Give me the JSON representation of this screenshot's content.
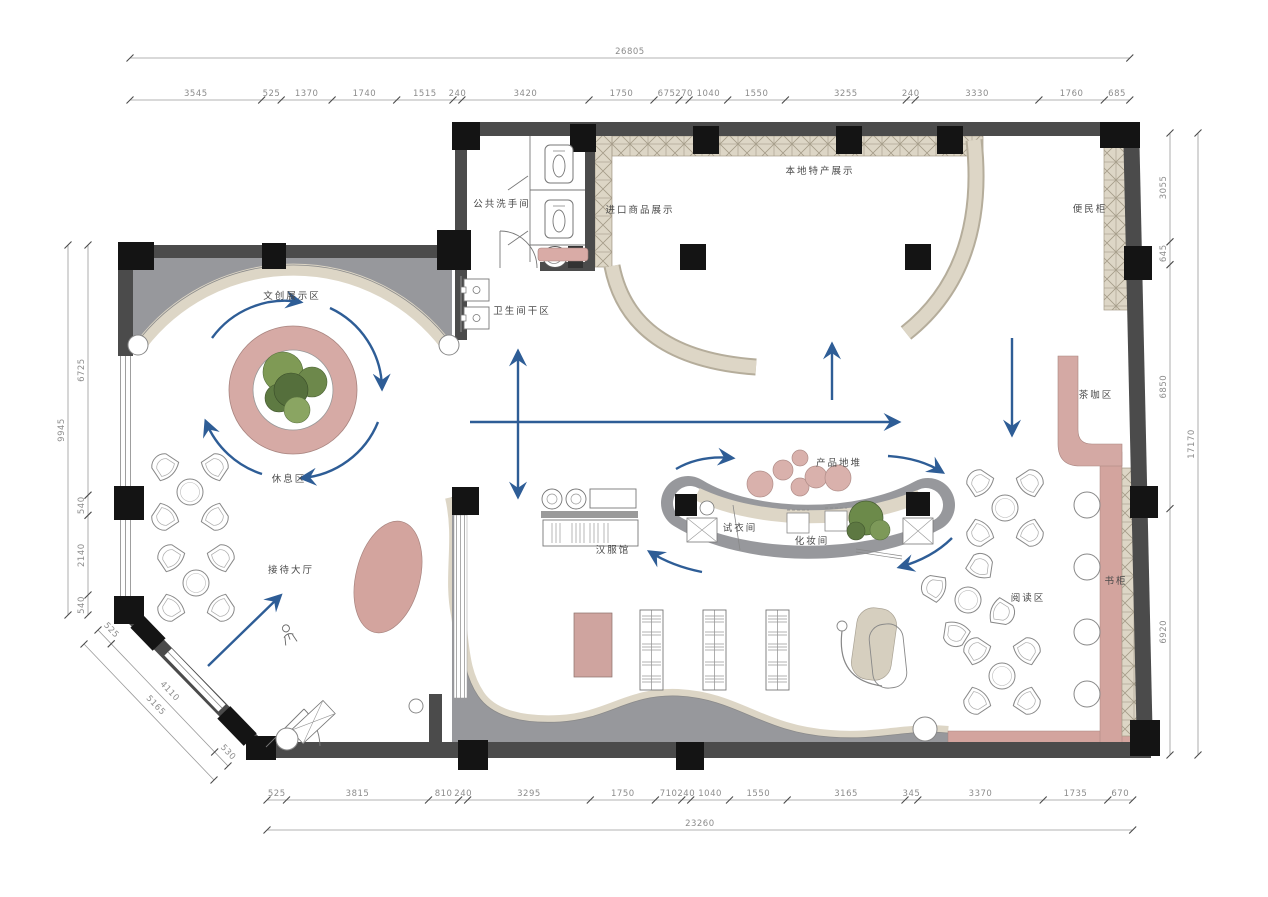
{
  "dims": {
    "top": {
      "overall": "26805",
      "values": [
        "3545",
        "525",
        "1370",
        "1740",
        "1515",
        "240",
        "3420",
        "1750",
        "675",
        "270",
        "1040",
        "1550",
        "3255",
        "240",
        "3330",
        "1760",
        "685"
      ]
    },
    "bottom": {
      "overall": "23260",
      "values": [
        "525",
        "3815",
        "810",
        "240",
        "3295",
        "1750",
        "710",
        "240",
        "1040",
        "1550",
        "3165",
        "345",
        "3370",
        "1735",
        "670"
      ]
    },
    "left": {
      "overall": "9945",
      "values": [
        "6725",
        "540",
        "2140",
        "540"
      ]
    },
    "right": {
      "overall": "17170",
      "values": [
        "3055",
        "645",
        "6850",
        "6920"
      ]
    },
    "diagonal": {
      "overall": "5165",
      "values": [
        "525",
        "4110",
        "530"
      ]
    }
  },
  "rooms": {
    "public_washroom": "公共洗手间",
    "toilet_dry_area": "卫生间干区",
    "imported_goods_display": "进口商品展示",
    "local_specialty_display": "本地特产展示",
    "convenience_cabinet": "便民柜",
    "cultural_creative_display": "文创展示区",
    "rest_area": "休息区",
    "reception_hall": "接待大厅",
    "tea_coffee_area": "茶咖区",
    "product_floor_stack": "产品地堆",
    "fitting_room": "试衣间",
    "makeup_room": "化妆间",
    "hanfu_hall": "汉服馆",
    "reading_area": "阅读区",
    "bookcase": "书柜"
  },
  "colors": {
    "wall": "#4b4b4b",
    "column": "#141414",
    "gray_zone": "#97989c",
    "beige": "#ddd6c6",
    "pink": "#d6aaa5",
    "arrow_blue": "#2e5d96",
    "dimension": "#8c8c8c",
    "plant_green": "#7f9a55"
  }
}
